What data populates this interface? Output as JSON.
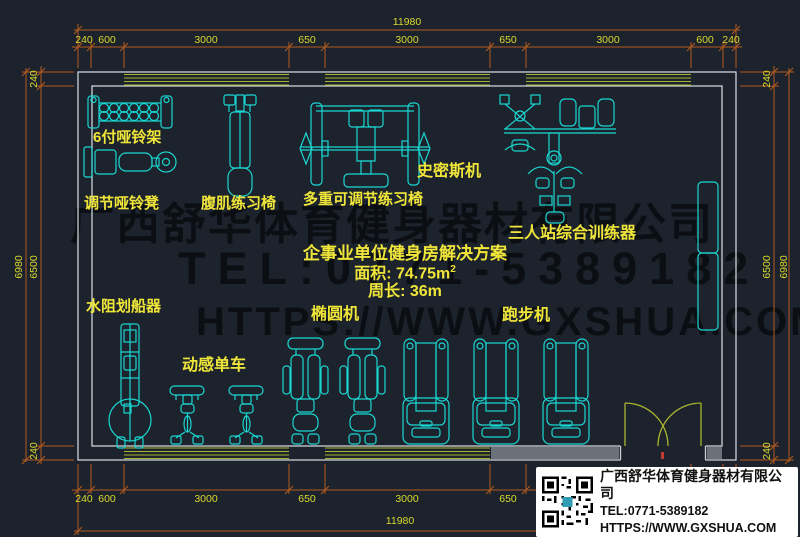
{
  "plan": {
    "equipment_labels": {
      "dumbbell_rack": "6付哑铃架",
      "adjustable_dumbbell_bench": "调节哑铃凳",
      "ab_trainer_chair": "腹肌练习椅",
      "multi_adjustable_bench": "多重可调节练习椅",
      "smith_machine": "史密斯机",
      "three_person_station": "三人站综合训练器",
      "water_rower": "水阻划船器",
      "spin_bike": "动感单车",
      "elliptical": "椭圆机",
      "treadmill": "跑步机"
    },
    "solution_text": {
      "title": "企事业单位健身房解决方案",
      "area": "面积: 74.75m",
      "area_sup": "2",
      "perimeter": "周长: 36m"
    },
    "dimensions": {
      "top": {
        "total": "11980",
        "segments": [
          "240",
          "600",
          "3000",
          "650",
          "3000",
          "650",
          "3000",
          "600",
          "240"
        ]
      },
      "bottom": {
        "total": "11980",
        "segments": [
          "240",
          "600",
          "3000",
          "650",
          "3000",
          "650",
          "3000",
          "600",
          "240"
        ]
      },
      "left": {
        "total": "6980",
        "segments": [
          "240",
          "6500",
          "240"
        ]
      },
      "right": {
        "total": "6980",
        "segments": [
          "240",
          "6500",
          "240"
        ]
      }
    },
    "watermark": {
      "company": "广西舒华体育健身器材有限公司",
      "tel": "TEL:0771-5389182",
      "url": "HTTPS://WWW.GXSHUA.COM"
    }
  },
  "info_card": {
    "company": "广西舒华体育健身器材有限公司",
    "tel": "TEL:0771-5389182",
    "url": "HTTPS://WWW.GXSHUA.COM"
  },
  "colors": {
    "background": "#1d232c",
    "equipment": "#1ad6d1",
    "labels": "#f0e63a",
    "walls": "#cdd2d8",
    "windows_doors": "#a9b52f",
    "dimension_lines": "#b35b1f",
    "dimension_text": "#d9d92e"
  }
}
